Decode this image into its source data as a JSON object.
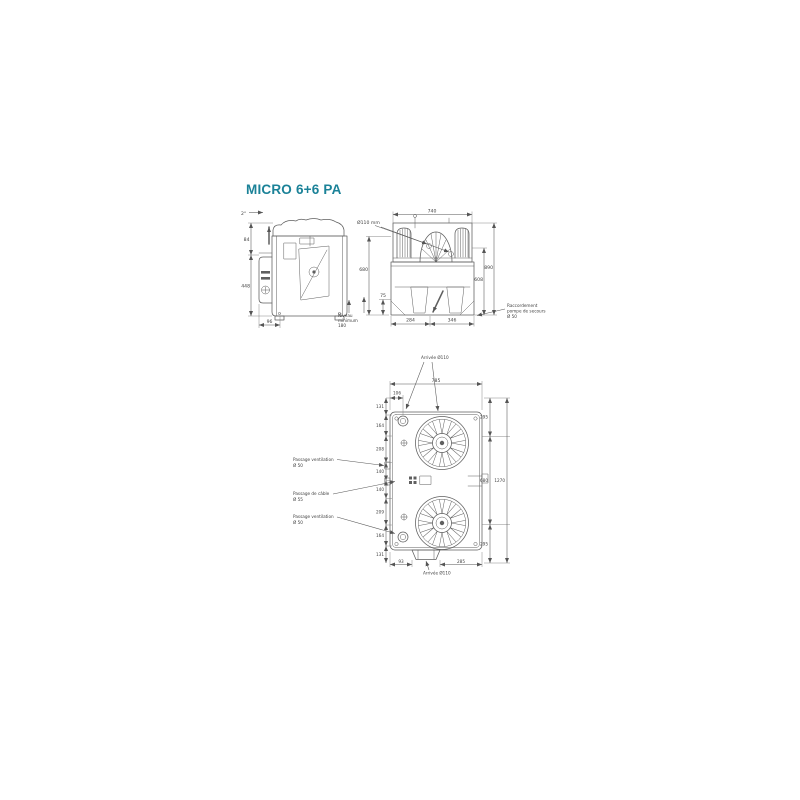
{
  "page": {
    "title": "MICRO 6+6 PA",
    "accent_color": "#1b8298",
    "line_color": "#5f5f5f"
  },
  "side_view": {
    "slope": "2°",
    "dim_upper": "84",
    "dim_height": "448",
    "dim_bottom": "96",
    "level_note": [
      "Niveau",
      "minimum",
      "180"
    ]
  },
  "front_view": {
    "inlet_label": "Ø110 mm",
    "dim_width": "740",
    "dim_left_height": "680",
    "dim_left_small": "75",
    "dim_right_inner": "608",
    "dim_right_outer": "890",
    "dim_bottom_left": "284",
    "dim_bottom_right": "346",
    "connection_note": [
      "Raccordement",
      "pompe de secours",
      "Ø 50"
    ]
  },
  "plan_view": {
    "inlet_top_label": "Arrivée Ø110",
    "inlet_bottom_label": "Arrivée Ø110",
    "dim_width": "785",
    "dim_width_small": "106",
    "left_chain": [
      "131",
      "164",
      "208",
      "140",
      "140",
      "209",
      "164",
      "131"
    ],
    "right_chain": [
      "295",
      "680",
      "295"
    ],
    "dim_total": "1270",
    "dim_bottom_small": "93",
    "dim_bottom": "285",
    "vent_top_label": [
      "Passage ventilation",
      "Ø 50"
    ],
    "cable_label": [
      "Passage de câble",
      "Ø 55"
    ],
    "vent_bottom_label": [
      "Passage ventilation",
      "Ø 50"
    ]
  }
}
